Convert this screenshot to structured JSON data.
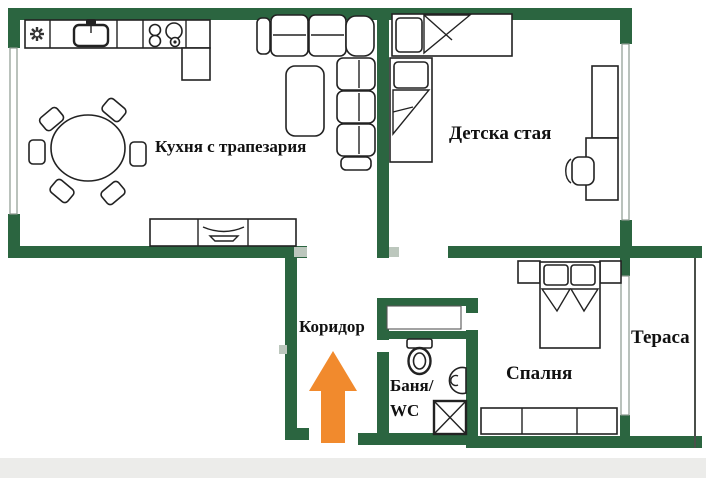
{
  "plan": {
    "rooms": {
      "kitchen": {
        "label": "Кухня с трапезария"
      },
      "kids_room": {
        "label": "Детска стая"
      },
      "corridor": {
        "label": "Коридор"
      },
      "bathroom": {
        "label_line1": "Баня/",
        "label_line2": "WC"
      },
      "bedroom": {
        "label": "Спалня"
      },
      "terrace": {
        "label": "Тераса"
      }
    },
    "entrance_arrow": {
      "direction": "up"
    },
    "colors": {
      "wall": "#2b6540",
      "outline": "#222222",
      "thin_line": "#8d998f",
      "door_mark": "#bcc7bd",
      "text": "#111111",
      "arrow": "#f18a2d",
      "background": "#ffffff",
      "bottom_bar": "#ececea"
    }
  }
}
